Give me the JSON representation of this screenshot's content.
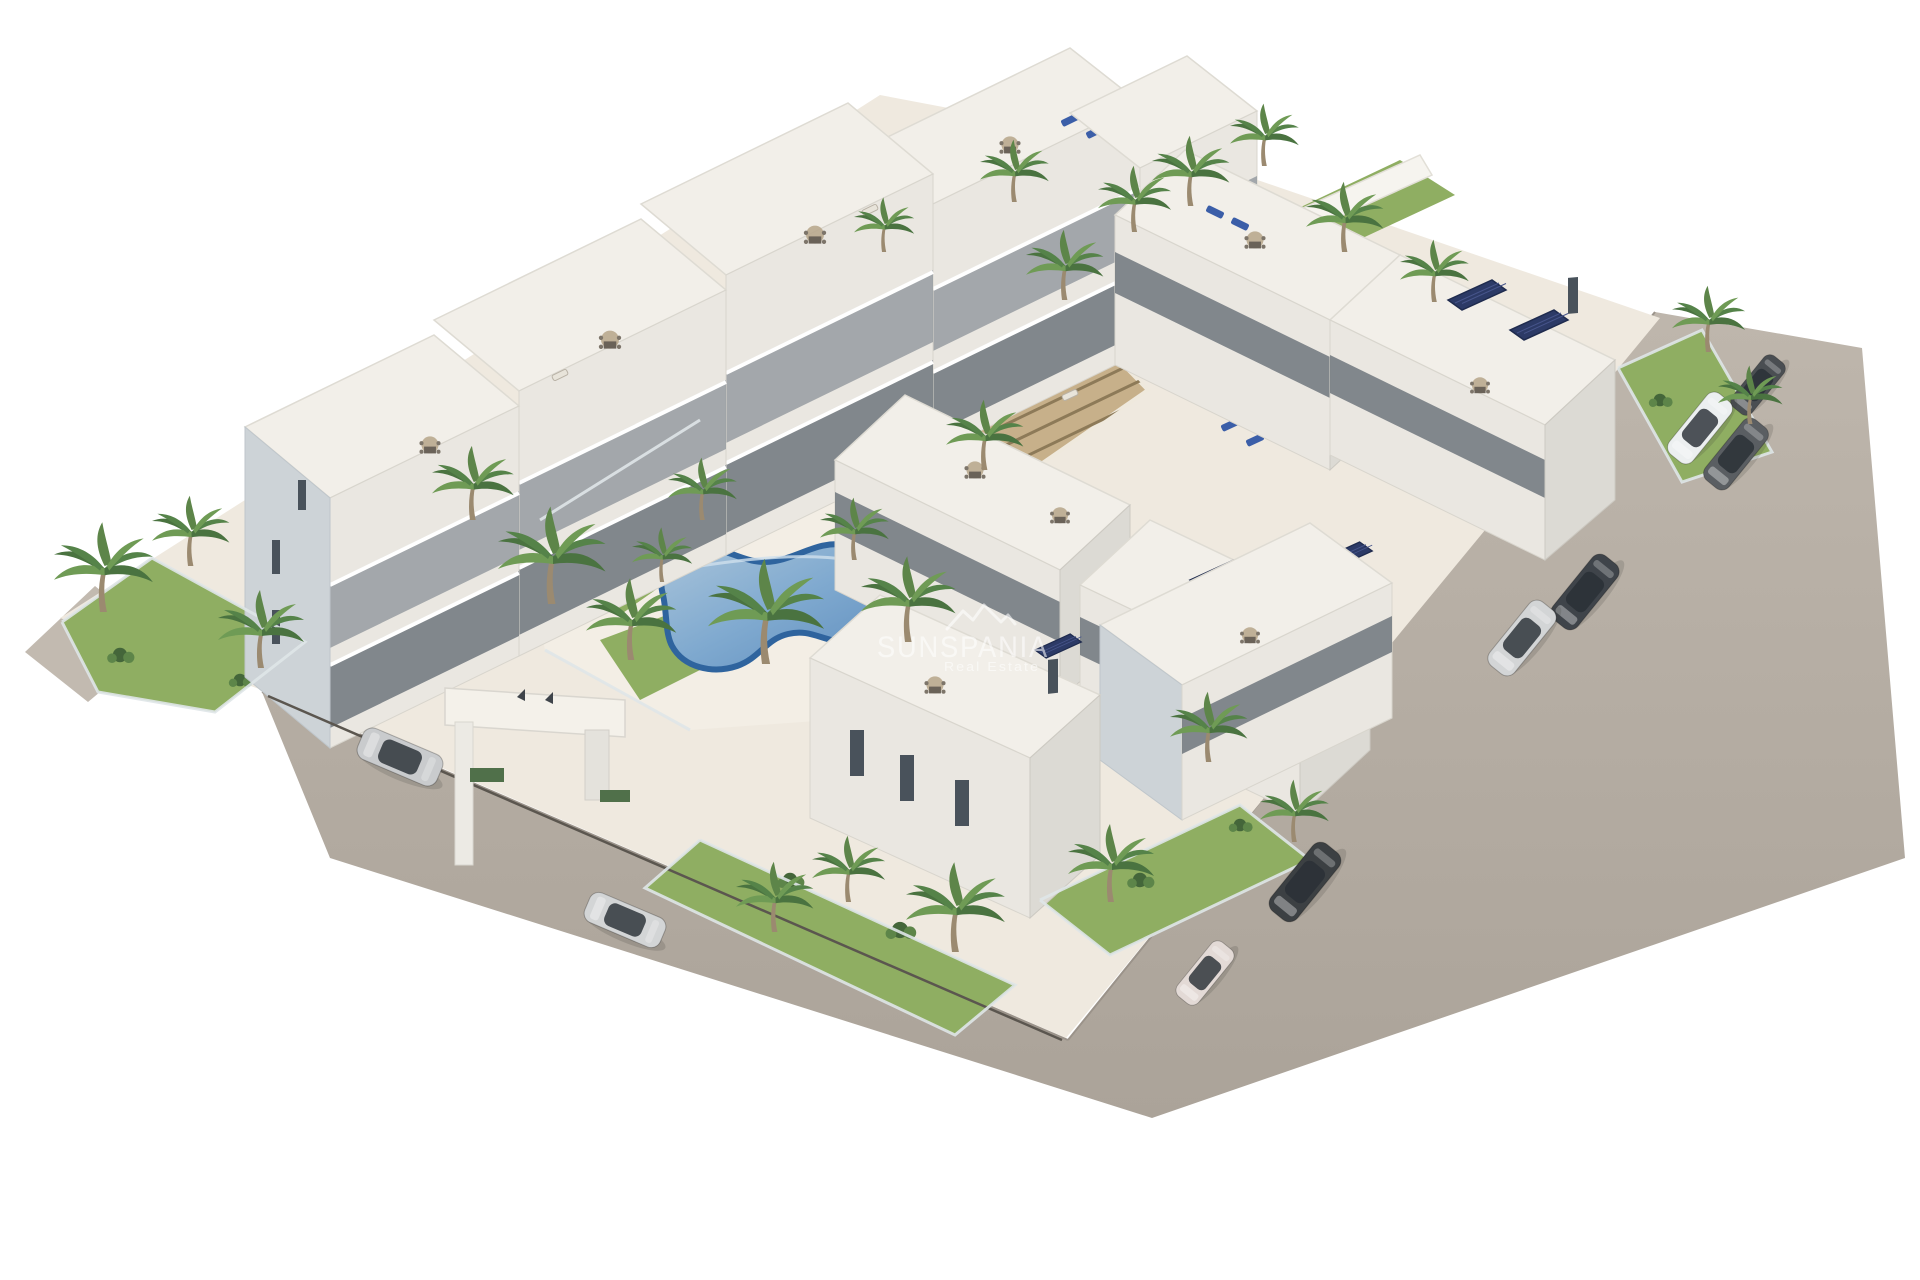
{
  "scene": {
    "type": "3d-architectural-render",
    "subject": "Aerial view of a new-build white residential apartment complex with two communal swimming pools, palm gardens, rooftop terraces, solar panels, an entrance gate and perimeter roads with parked cars",
    "background_color": "#ffffff"
  },
  "watermark": {
    "brand": "SUNSPANIA",
    "tagline": "Real Estate",
    "logo": "mountain-peaks-icon",
    "color": "#ffffff",
    "opacity": 0.58
  },
  "palette": {
    "background": "#ffffff",
    "platform_cream": "#efe9df",
    "deck_cream": "#f3eee5",
    "road": "#b5ada3",
    "roof_white": "#f2efe9",
    "wall_light": "#eae7e1",
    "wall_shadow_blue": "#cdd3d7",
    "window_dark": "#49525b",
    "pool_water": "#7fa9cf",
    "pool_rim": "#2f649e",
    "grass_green": "#8fae62",
    "shrub_green": "#44663a",
    "palm_green": "#4a7340",
    "pergola_wood": "#c0a883",
    "solar_panel": "#2c3a66",
    "car_silver": "#c9cbcd",
    "car_dark": "#3c4043",
    "car_white": "#eceff0"
  },
  "features": {
    "pools": [
      {
        "shape": "kidney",
        "location": "south-west courtyard"
      },
      {
        "shape": "rectangular",
        "location": "north-east courtyard"
      }
    ],
    "building_rows": [
      {
        "name": "north-west row",
        "floors": 3,
        "note": "stepped rooftop terraces with dining sets"
      },
      {
        "name": "north-east row",
        "floors": 3,
        "note": "roof terraces, blue sun loungers, solar panels"
      },
      {
        "name": "middle east row",
        "floors": 3,
        "note": "solar panels on roofs"
      },
      {
        "name": "south row",
        "floors": 3,
        "note": "private gardens with glass fences"
      }
    ],
    "entrance_gate": {
      "location": "south-west road",
      "style": "white portal with two flags"
    },
    "pergola": {
      "material": "wood slats",
      "location": "central courtyard"
    },
    "cars": [
      {
        "color": "silver SUV",
        "location": "west road"
      },
      {
        "color": "silver sedan",
        "location": "west road"
      },
      {
        "color": "dark compact SUV",
        "location": "east road top"
      },
      {
        "color": "white SUV",
        "location": "east road"
      },
      {
        "color": "dark SUV",
        "location": "east road"
      },
      {
        "color": "dark sedan",
        "location": "east road"
      },
      {
        "color": "silver sedan",
        "location": "east road"
      },
      {
        "color": "dark SUV",
        "location": "east road bottom"
      },
      {
        "color": "white city car",
        "location": "south-east corner"
      }
    ],
    "vegetation": {
      "palm_trees": 28,
      "lawns": 7,
      "shrub_clusters": 14
    }
  }
}
